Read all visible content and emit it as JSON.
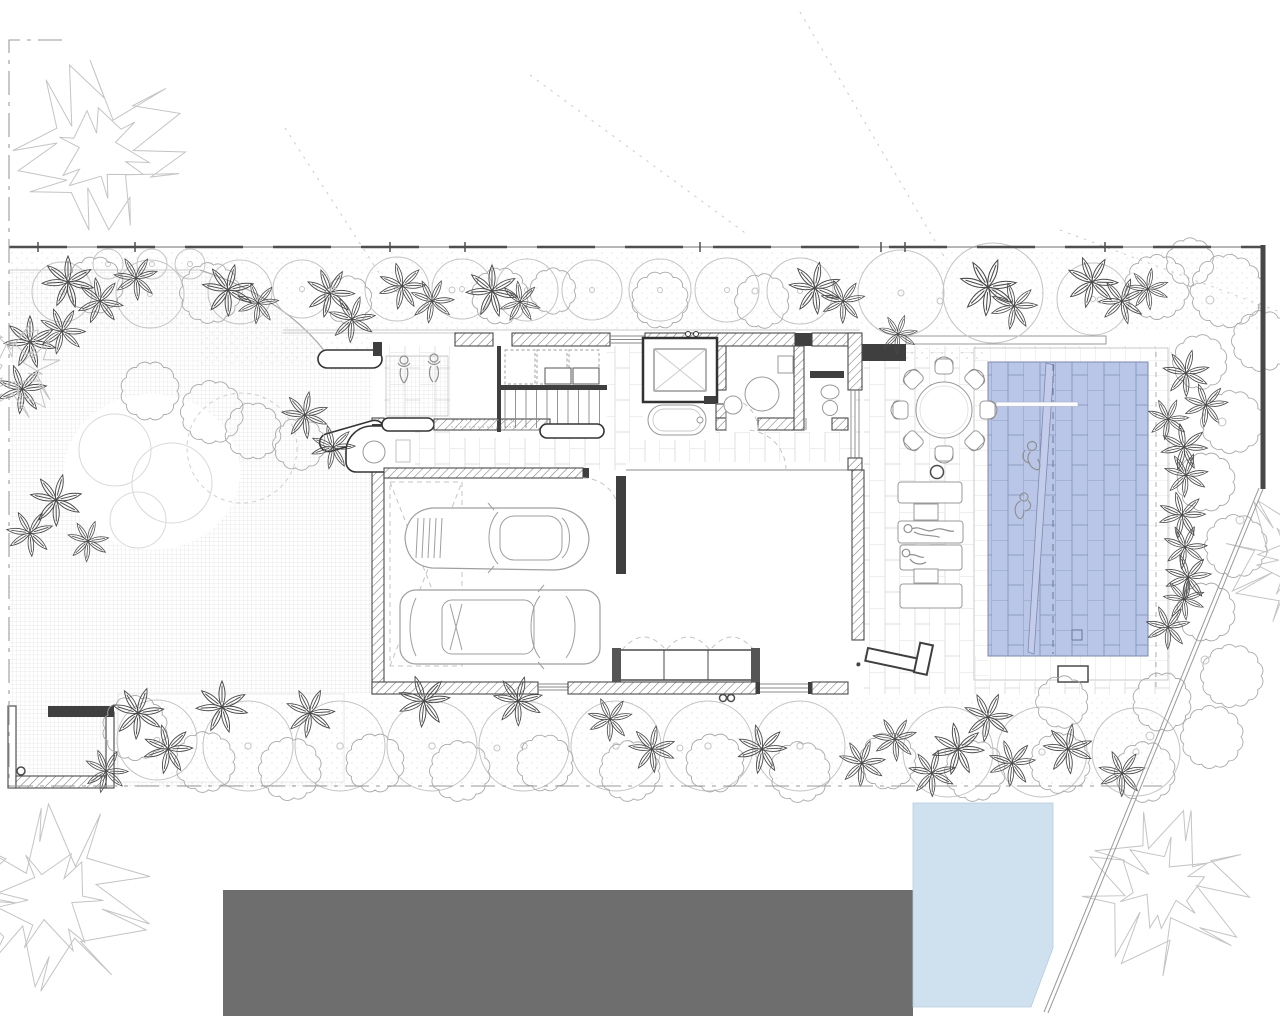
{
  "colors": {
    "paper": "#ffffff",
    "ink": "#3c3c3c",
    "tree": "#c4c4c4",
    "plant_dark": "#4a4a4a",
    "pool_fill": "#b9c6e7",
    "pool_line": "#8290ba",
    "water_fill": "#cfe0ee",
    "road_fill": "#6e6e6e",
    "tile_line": "#dcdcdc",
    "grid_line": "#d6d6d6"
  },
  "scene": {
    "round_trees_top": [
      [
        62,
        292,
        30
      ],
      [
        150,
        294,
        34
      ],
      [
        240,
        292,
        32
      ],
      [
        302,
        289,
        29
      ],
      [
        397,
        289,
        32
      ],
      [
        462,
        289,
        30
      ],
      [
        527,
        290,
        31
      ],
      [
        592,
        290,
        30
      ],
      [
        660,
        290,
        31
      ],
      [
        727,
        290,
        32
      ],
      [
        800,
        291,
        33
      ],
      [
        901,
        293,
        43
      ],
      [
        993,
        293,
        50
      ],
      [
        1093,
        299,
        36
      ]
    ],
    "small_trees": [
      [
        108,
        264,
        15
      ],
      [
        152,
        264,
        15
      ],
      [
        190,
        264,
        15
      ]
    ],
    "round_trees_bottom": [
      [
        157,
        740,
        40
      ],
      [
        248,
        746,
        45
      ],
      [
        340,
        746,
        45
      ],
      [
        432,
        746,
        45
      ],
      [
        524,
        746,
        45
      ],
      [
        616,
        746,
        45
      ],
      [
        708,
        746,
        45
      ],
      [
        800,
        746,
        45
      ],
      [
        948,
        752,
        45
      ],
      [
        1042,
        752,
        45
      ],
      [
        1136,
        752,
        44
      ]
    ],
    "shrubs": [
      [
        95,
        285,
        26
      ],
      [
        210,
        293,
        28
      ],
      [
        348,
        300,
        22
      ],
      [
        500,
        296,
        26
      ],
      [
        553,
        291,
        21
      ],
      [
        660,
        300,
        26
      ],
      [
        762,
        301,
        25
      ],
      [
        1157,
        287,
        30
      ],
      [
        1227,
        291,
        34
      ],
      [
        1262,
        341,
        28
      ],
      [
        1190,
        262,
        22
      ],
      [
        150,
        391,
        27
      ],
      [
        212,
        412,
        29
      ],
      [
        253,
        431,
        26
      ],
      [
        299,
        444,
        24
      ],
      [
        135,
        728,
        30
      ],
      [
        205,
        762,
        28
      ],
      [
        290,
        769,
        29
      ],
      [
        375,
        763,
        27
      ],
      [
        460,
        771,
        28
      ],
      [
        545,
        763,
        26
      ],
      [
        630,
        771,
        28
      ],
      [
        715,
        763,
        27
      ],
      [
        800,
        772,
        28
      ],
      [
        888,
        761,
        26
      ],
      [
        975,
        771,
        28
      ],
      [
        1060,
        763,
        28
      ],
      [
        1145,
        772,
        28
      ],
      [
        1062,
        702,
        24
      ],
      [
        1200,
        362,
        25
      ],
      [
        1232,
        422,
        29
      ],
      [
        1206,
        482,
        27
      ],
      [
        1236,
        546,
        29
      ],
      [
        1206,
        612,
        27
      ],
      [
        1232,
        676,
        29
      ],
      [
        1162,
        702,
        27
      ],
      [
        1212,
        737,
        29
      ]
    ],
    "palms": [
      [
        68,
        282,
        1,
        0
      ],
      [
        100,
        301,
        0.9,
        40
      ],
      [
        136,
        278,
        0.85,
        -30
      ],
      [
        228,
        290,
        1,
        15
      ],
      [
        258,
        303,
        0.8,
        -20
      ],
      [
        330,
        293,
        0.95,
        30
      ],
      [
        402,
        286,
        0.9,
        -15
      ],
      [
        432,
        301,
        0.85,
        25
      ],
      [
        492,
        291,
        1,
        0
      ],
      [
        520,
        302,
        0.8,
        45
      ],
      [
        815,
        288,
        1,
        10
      ],
      [
        843,
        301,
        0.85,
        -25
      ],
      [
        988,
        287,
        1.1,
        20
      ],
      [
        1014,
        306,
        0.9,
        -15
      ],
      [
        1092,
        282,
        1,
        30
      ],
      [
        1122,
        301,
        0.9,
        -40
      ],
      [
        1148,
        289,
        0.8,
        10
      ],
      [
        898,
        334,
        0.75,
        20
      ],
      [
        30,
        342,
        1,
        0
      ],
      [
        62,
        331,
        0.9,
        30
      ],
      [
        22,
        389,
        0.95,
        -20
      ],
      [
        56,
        500,
        1,
        15
      ],
      [
        30,
        533,
        0.9,
        -30
      ],
      [
        88,
        541,
        0.8,
        20
      ],
      [
        305,
        415,
        0.9,
        10
      ],
      [
        333,
        447,
        0.85,
        -15
      ],
      [
        352,
        319,
        0.9,
        20
      ],
      [
        138,
        713,
        1,
        20
      ],
      [
        168,
        749,
        0.95,
        -15
      ],
      [
        106,
        771,
        0.85,
        30
      ],
      [
        222,
        707,
        1,
        0
      ],
      [
        310,
        713,
        0.95,
        25
      ],
      [
        424,
        701,
        1,
        -20
      ],
      [
        518,
        701,
        0.95,
        15
      ],
      [
        610,
        719,
        0.85,
        -25
      ],
      [
        652,
        749,
        0.9,
        10
      ],
      [
        762,
        749,
        0.95,
        -15
      ],
      [
        862,
        763,
        0.9,
        20
      ],
      [
        895,
        739,
        0.85,
        -30
      ],
      [
        932,
        773,
        0.9,
        15
      ],
      [
        958,
        749,
        1,
        -10
      ],
      [
        988,
        717,
        0.95,
        25
      ],
      [
        1012,
        763,
        0.9,
        -20
      ],
      [
        1068,
        749,
        0.95,
        10
      ],
      [
        1122,
        773,
        0.9,
        -25
      ],
      [
        1186,
        373,
        0.9,
        15
      ],
      [
        1206,
        405,
        0.85,
        -20
      ],
      [
        1168,
        419,
        0.8,
        25
      ],
      [
        1184,
        447,
        0.9,
        -10
      ],
      [
        1186,
        475,
        0.85,
        20
      ],
      [
        1182,
        515,
        0.9,
        -15
      ],
      [
        1185,
        547,
        0.85,
        25
      ],
      [
        1188,
        577,
        0.9,
        -20
      ],
      [
        1184,
        599,
        0.8,
        10
      ],
      [
        1168,
        627,
        0.85,
        -25
      ]
    ],
    "big_trees": [
      [
        100,
        152,
        90
      ],
      [
        52,
        900,
        98
      ],
      [
        1163,
        886,
        88
      ],
      [
        14,
        368,
        52
      ],
      [
        1296,
        560,
        70
      ]
    ],
    "lawn_circles": [
      [
        115,
        450,
        36
      ],
      [
        172,
        483,
        40
      ],
      [
        138,
        520,
        28
      ]
    ],
    "dashed_circle": [
      242,
      448,
      55
    ],
    "deco_circles": [
      [
        1210,
        300,
        4
      ],
      [
        1262,
        306,
        3
      ],
      [
        1222,
        422,
        4
      ],
      [
        1240,
        520,
        4
      ],
      [
        1205,
        660,
        4
      ],
      [
        1150,
        736,
        4
      ],
      [
        755,
        291,
        3
      ],
      [
        940,
        301,
        3
      ],
      [
        452,
        290,
        3
      ],
      [
        333,
        290,
        3
      ],
      [
        1100,
        300,
        3
      ],
      [
        680,
        748,
        3
      ],
      [
        497,
        748,
        3
      ]
    ],
    "dotted_guides": [
      [
        285,
        128,
        385,
        282
      ],
      [
        530,
        75,
        748,
        235
      ],
      [
        800,
        12,
        945,
        258
      ],
      [
        1060,
        230,
        1280,
        312
      ]
    ],
    "boundary_ticks": [
      38,
      135,
      390,
      465,
      700,
      881,
      905,
      1105
    ],
    "dining_chair_angles": [
      0,
      45,
      90,
      135,
      180,
      225,
      270,
      315
    ],
    "loungers": [
      [
        898,
        482,
        64,
        21
      ],
      [
        898,
        521,
        65,
        22
      ],
      [
        900,
        545,
        62,
        25
      ],
      [
        900,
        584,
        62,
        24
      ]
    ],
    "lounger_tables": [
      [
        914,
        504,
        24,
        16
      ],
      [
        914,
        569,
        24,
        14
      ]
    ],
    "stair_cabinets": [
      [
        505,
        350,
        30,
        34
      ],
      [
        537,
        350,
        30,
        34
      ],
      [
        569,
        350,
        30,
        34
      ]
    ],
    "stair_drawers": [
      [
        545,
        368,
        26,
        16
      ],
      [
        573,
        368,
        26,
        16
      ]
    ]
  }
}
